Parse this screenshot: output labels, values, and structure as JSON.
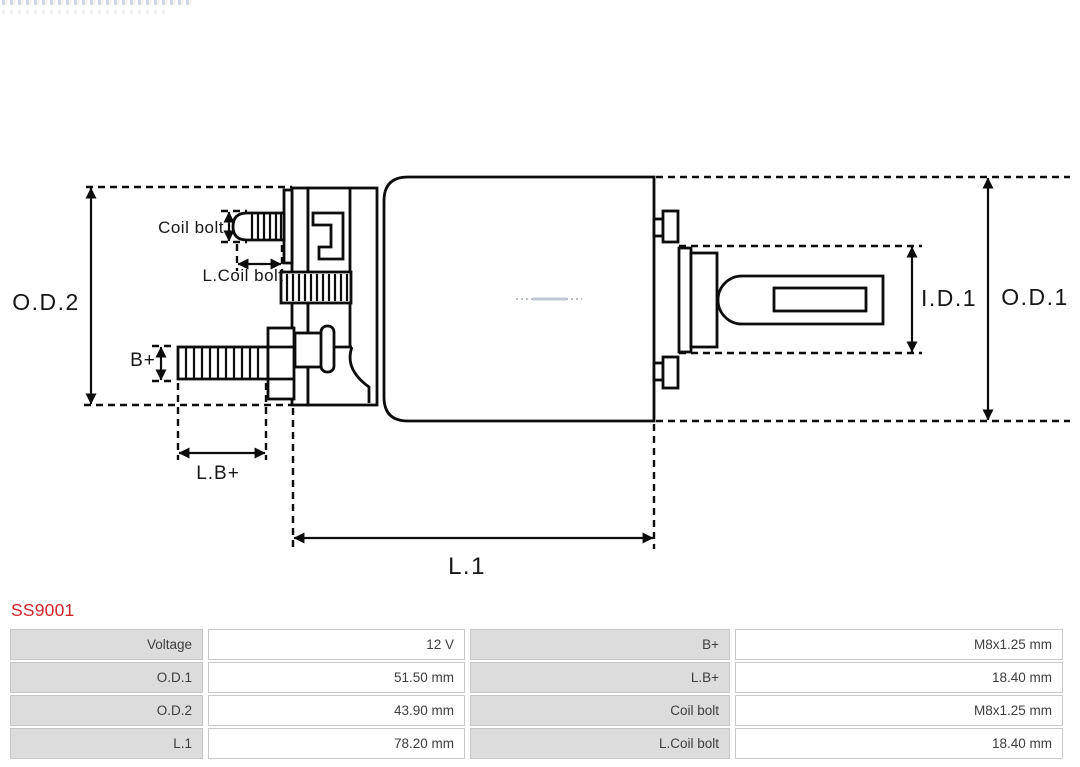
{
  "part": {
    "number": "SS9001"
  },
  "colors": {
    "accent_red": "#d02429",
    "drawing_line": "#0c0c0c",
    "table_label_bg": "#dcdcdc",
    "table_border": "#c9c9c9",
    "table_text": "#3d3d3d"
  },
  "diagram": {
    "labels": {
      "od2": "O.D.2",
      "od1": "O.D.1",
      "id1": "I.D.1",
      "l1": "L.1",
      "lb_plus": "L.B+",
      "b_plus": "B+",
      "coil_bolt": "Coil bolt",
      "l_coil_bolt": "L.Coil bolt"
    }
  },
  "spec_table": {
    "rows": [
      {
        "c0": "Voltage",
        "c1": "12 V",
        "c2": "B+",
        "c3": "M8x1.25 mm"
      },
      {
        "c0": "O.D.1",
        "c1": "51.50 mm",
        "c2": "L.B+",
        "c3": "18.40 mm"
      },
      {
        "c0": "O.D.2",
        "c1": "43.90 mm",
        "c2": "Coil bolt",
        "c3": "M8x1.25 mm"
      },
      {
        "c0": "L.1",
        "c1": "78.20 mm",
        "c2": "L.Coil bolt",
        "c3": "18.40 mm"
      }
    ]
  }
}
